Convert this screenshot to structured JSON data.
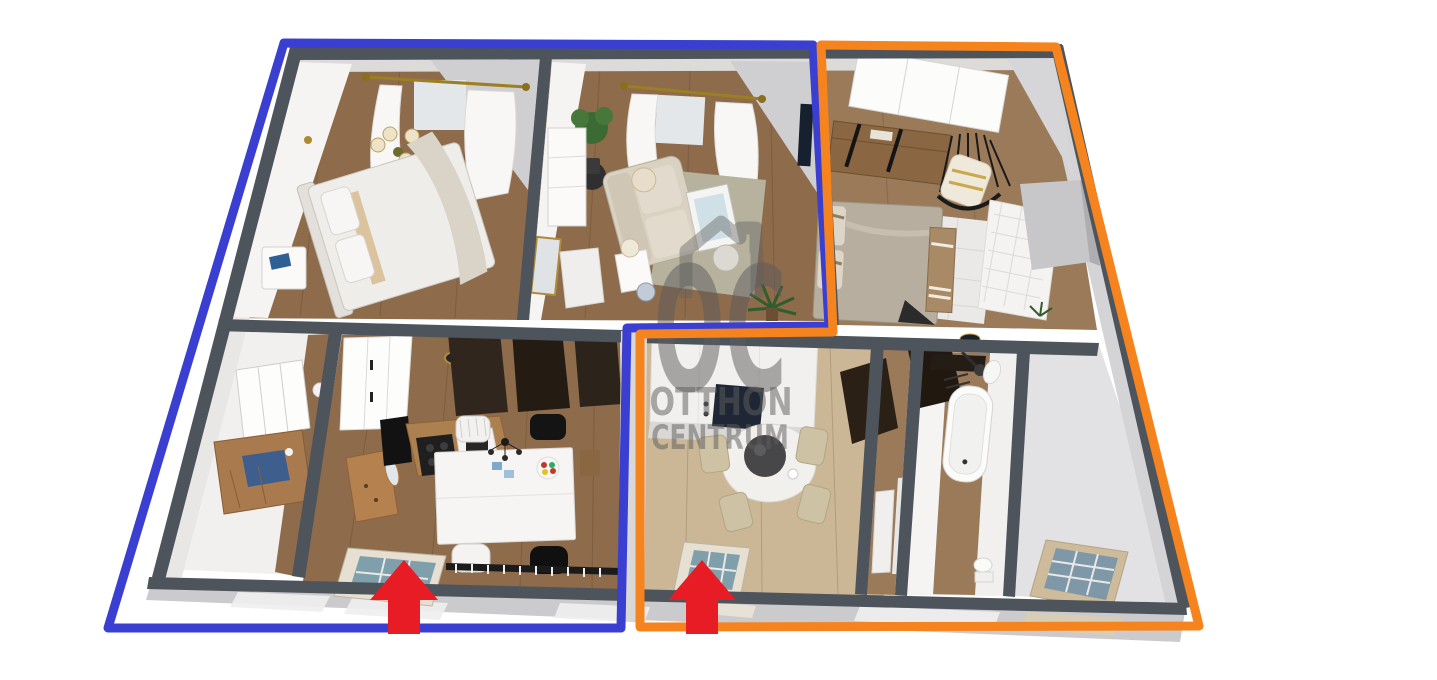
{
  "watermark": {
    "monogram": "OC",
    "line1": "OTTHON",
    "line2": "CENTRUM",
    "color": "#5d5d5d"
  },
  "annotations": {
    "unit_blue": {
      "color": "#3a3fd1",
      "points": "284,43 813,45 829,326 627,328 621,628 108,628"
    },
    "unit_orange": {
      "color": "#f5831e",
      "points": "821,45 1056,47 1199,626 640,627 640,334 833,332"
    },
    "entrance_arrows": {
      "color": "#e81c24",
      "items": [
        {
          "transform": "translate(404,598)"
        },
        {
          "transform": "translate(702,598)"
        }
      ]
    }
  },
  "palette": {
    "wall_dark": "#4d545c",
    "floor_wood": "#8d6b4b",
    "floor_wood_light": "#cbb795",
    "exterior_slab": "#cbcacd",
    "background": "#ffffff"
  }
}
